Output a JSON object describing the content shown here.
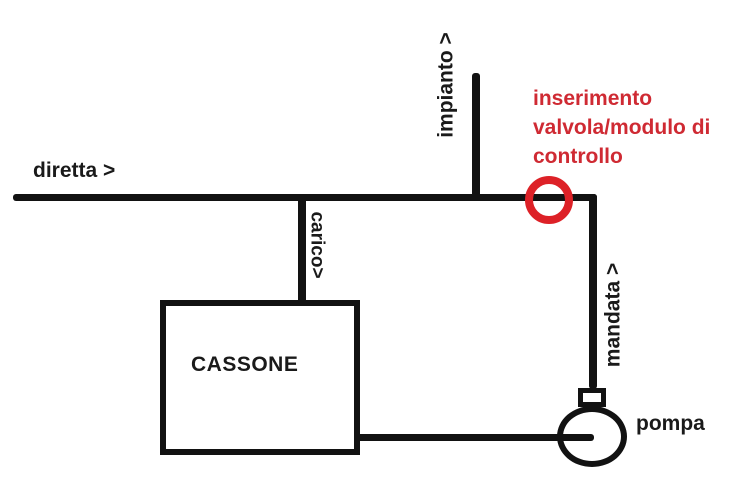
{
  "diagram": {
    "background": "#ffffff",
    "line_color": "#121212",
    "text_color": "#1a1a1a",
    "labels": {
      "diretta": "diretta >",
      "impianto": "impianto >",
      "carico": "carico>",
      "mandata": "mandata >",
      "cassone": "CASSONE",
      "pompa": "pompa"
    },
    "red_note": {
      "color": "#cf2a33",
      "lines": [
        "inserimento",
        "valvola/modulo di",
        "controllo"
      ]
    },
    "red_circle_color": "#dd2127"
  }
}
